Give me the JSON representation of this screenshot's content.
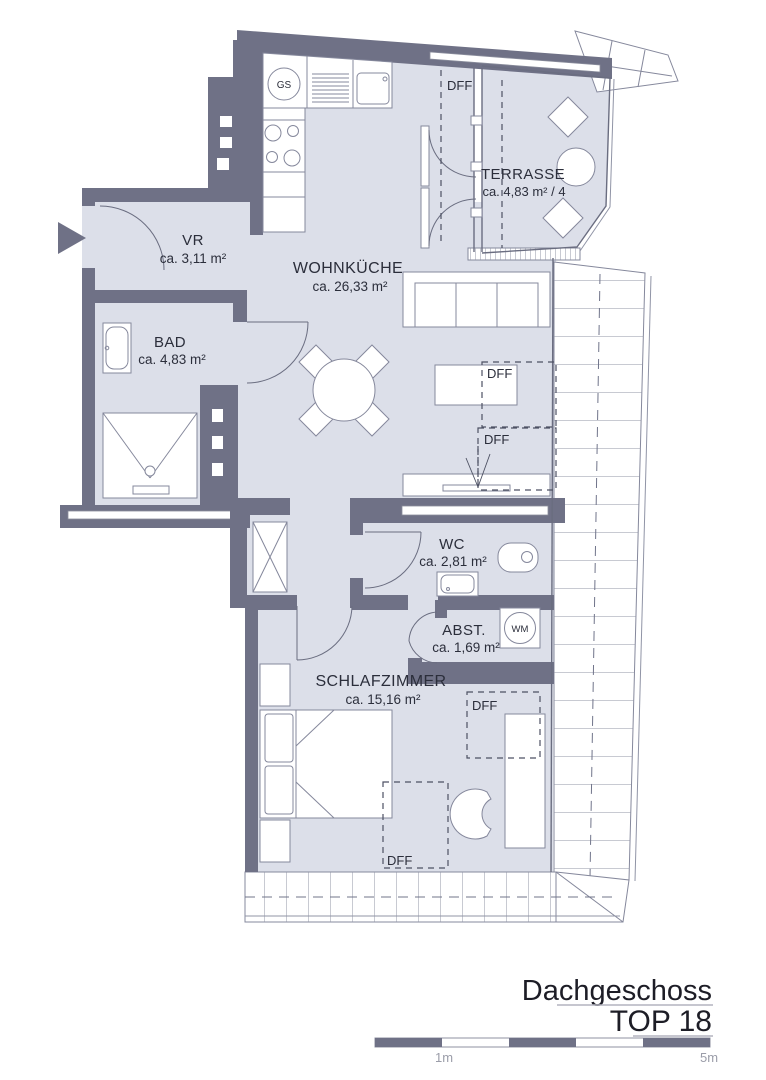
{
  "plan": {
    "floor": "Dachgeschoss",
    "unit": "TOP 18"
  },
  "rooms": {
    "vr": {
      "name": "VR",
      "area": "ca. 3,11 m²"
    },
    "bad": {
      "name": "BAD",
      "area": "ca. 4,83 m²"
    },
    "wohnkueche": {
      "name": "WOHNKÜCHE",
      "area": "ca. 26,33 m²"
    },
    "terrasse": {
      "name": "TERRASSE",
      "area": "ca. 4,83 m² / 4"
    },
    "wc": {
      "name": "WC",
      "area": "ca. 2,81 m²"
    },
    "abst": {
      "name": "ABST.",
      "area": "ca. 1,69 m²"
    },
    "schlafzimmer": {
      "name": "SCHLAFZIMMER",
      "area": "ca. 15,16 m²"
    }
  },
  "labels": {
    "roof_window": "DFF",
    "dishwasher": "GS",
    "washing_machine": "WM"
  },
  "scale_bar": {
    "mark_1m": "1m",
    "mark_5m": "5m"
  },
  "colors": {
    "wall": "#6f7186",
    "floor": "#dcdfe9",
    "outline": "#85889c",
    "text": "#2b2e3b"
  }
}
